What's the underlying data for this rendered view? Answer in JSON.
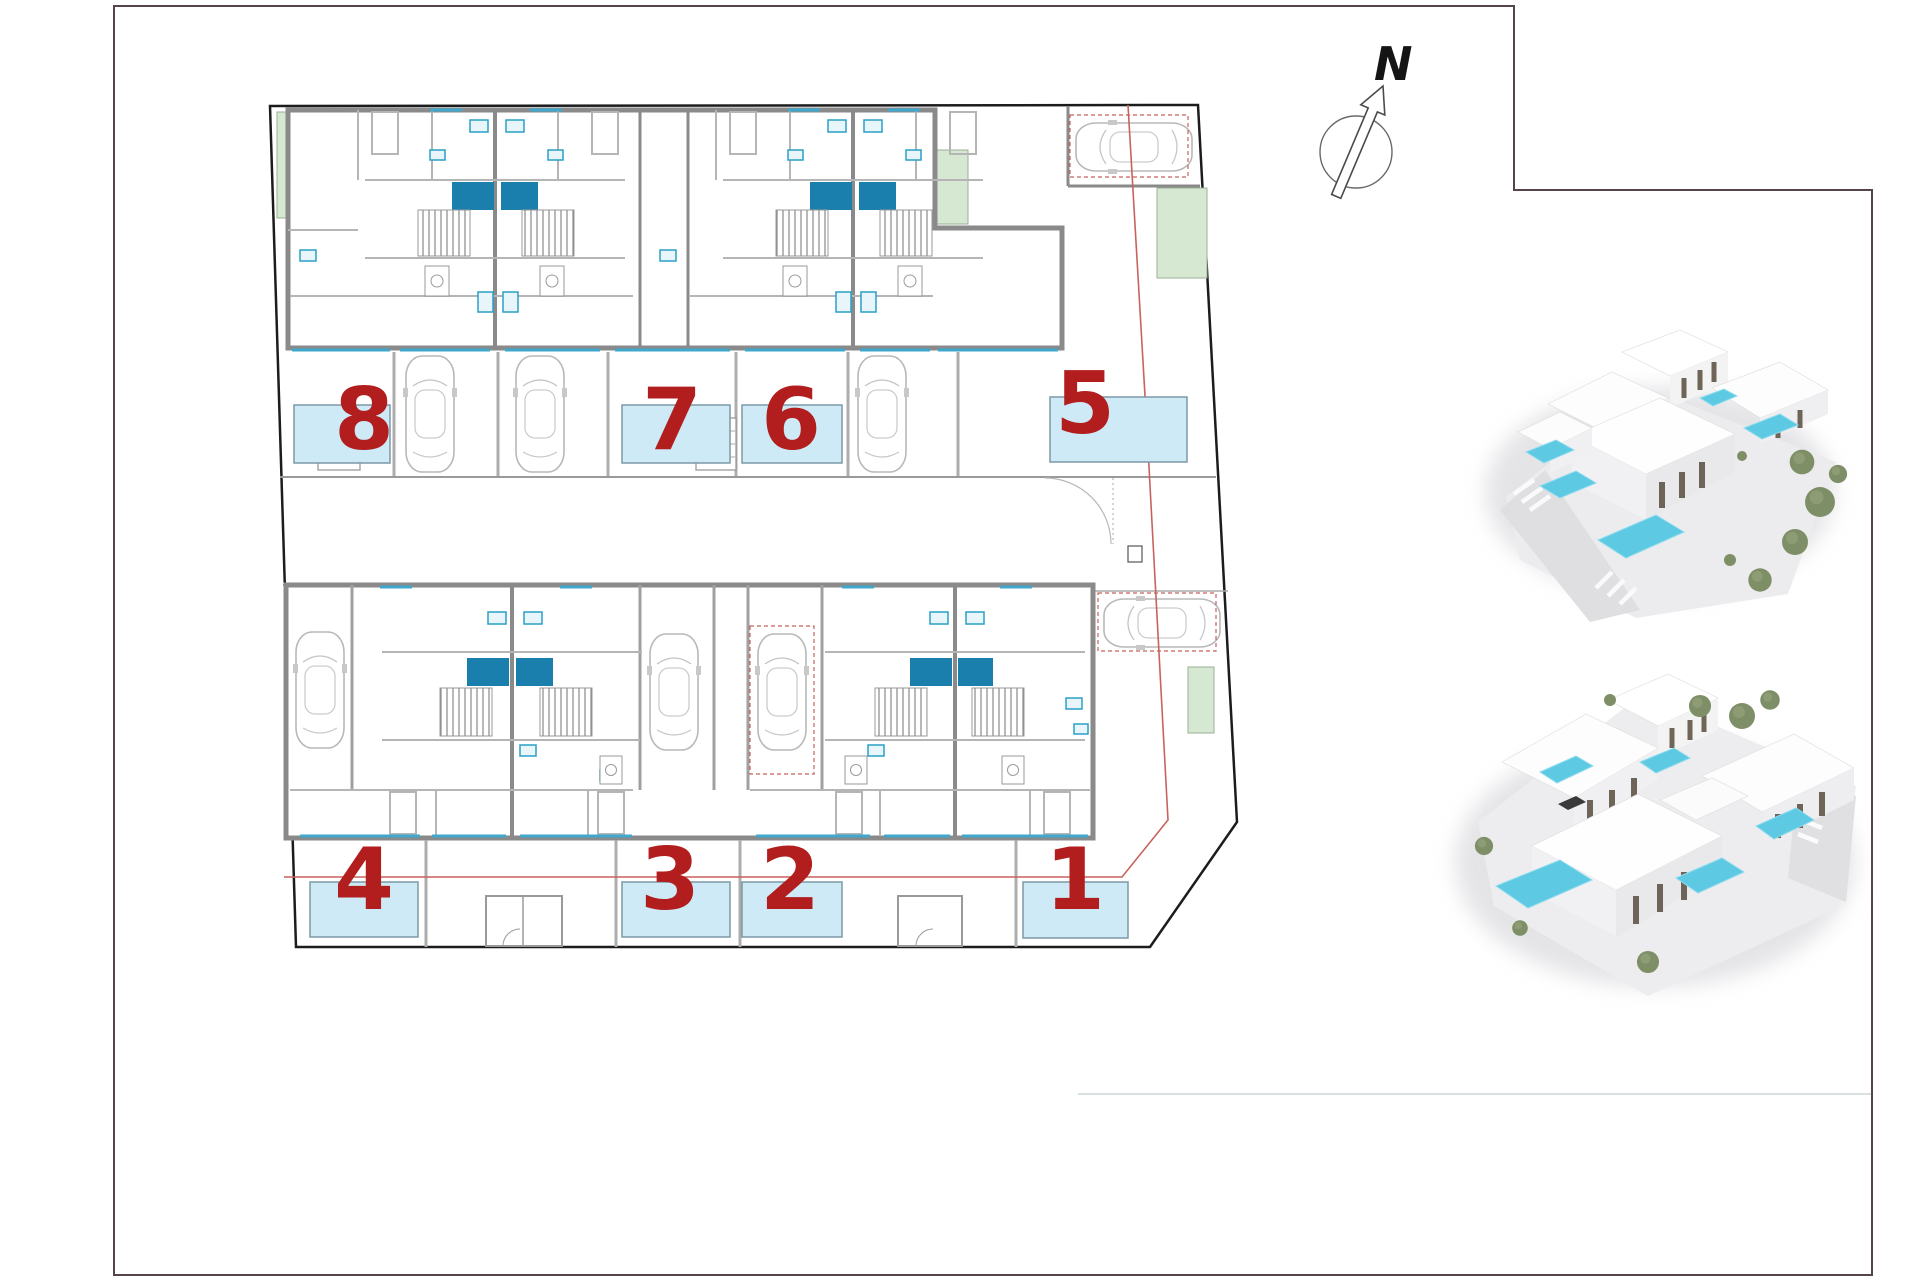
{
  "north_indicator": {
    "label": "N"
  },
  "site_plan": {
    "colors": {
      "number_color": "#b21d1d",
      "pool_fill": "#cdeaf6",
      "pool_stroke": "#7d99a5",
      "red_line": "#c9625c",
      "green_fill": "#d7e8d2",
      "green_stroke": "#9ab095",
      "kitchen_blue": "#1b7fae",
      "boundary": "#1c1c1c",
      "frame": "#55454b"
    },
    "units": [
      {
        "number": "8",
        "cx": 364,
        "cy": 418,
        "pool": {
          "x": 294,
          "y": 405,
          "w": 96,
          "h": 58
        }
      },
      {
        "number": "7",
        "cx": 672,
        "cy": 418,
        "pool": {
          "x": 622,
          "y": 405,
          "w": 108,
          "h": 58
        }
      },
      {
        "number": "6",
        "cx": 791,
        "cy": 418,
        "pool": {
          "x": 742,
          "y": 405,
          "w": 100,
          "h": 58
        }
      },
      {
        "number": "5",
        "cx": 1085,
        "cy": 402,
        "pool": {
          "x": 1050,
          "y": 397,
          "w": 137,
          "h": 65
        }
      },
      {
        "number": "4",
        "cx": 364,
        "cy": 878,
        "pool": {
          "x": 310,
          "y": 882,
          "w": 108,
          "h": 55
        }
      },
      {
        "number": "3",
        "cx": 670,
        "cy": 878,
        "pool": {
          "x": 622,
          "y": 882,
          "w": 108,
          "h": 55
        }
      },
      {
        "number": "2",
        "cx": 790,
        "cy": 878,
        "pool": {
          "x": 742,
          "y": 882,
          "w": 100,
          "h": 55
        }
      },
      {
        "number": "1",
        "cx": 1075,
        "cy": 878,
        "pool": {
          "x": 1023,
          "y": 882,
          "w": 105,
          "h": 56
        }
      }
    ]
  }
}
